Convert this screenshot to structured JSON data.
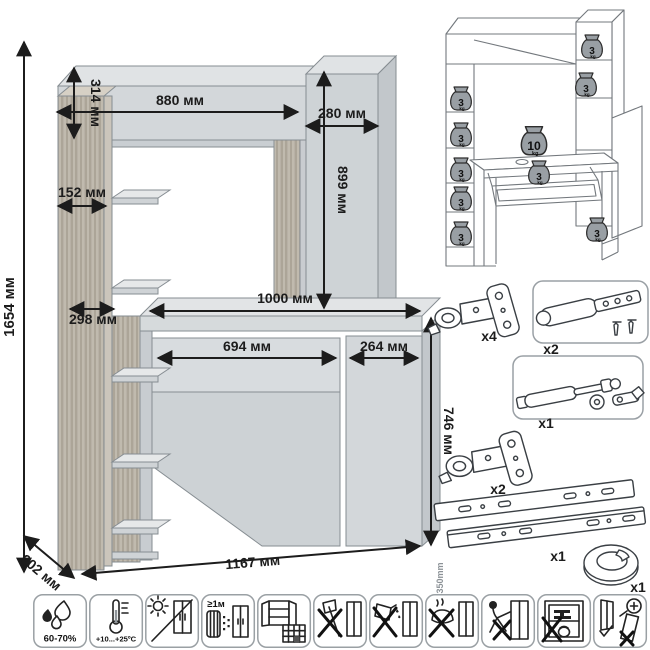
{
  "colors": {
    "panel": "#d3d7da",
    "panel_light": "#e0e3e5",
    "panel_side": "#c2c7cb",
    "wood": "#b8b1a6",
    "outline": "#868d92",
    "dimension": "#1c1c1c",
    "weight_fill": "#999fa4"
  },
  "dimensions": {
    "total_height": "1654 мм",
    "hutch_height": "314 мм",
    "hutch_width": "880 мм",
    "side_cabinet_width": "280 мм",
    "opening_height": "899 мм",
    "shelf_depth": "152 мм",
    "shelf_width": "298 мм",
    "desktop_width": "1000 мм",
    "drawer_width": "694 мм",
    "door_width": "264 мм",
    "desk_height": "746 мм",
    "depth": "602 мм",
    "total_width": "1167 мм"
  },
  "load_diagram": {
    "unit": "kg",
    "weights": [
      {
        "value": "3"
      },
      {
        "value": "3"
      },
      {
        "value": "3"
      },
      {
        "value": "3"
      },
      {
        "value": "3"
      },
      {
        "value": "3"
      },
      {
        "value": "3"
      },
      {
        "value": "10"
      },
      {
        "value": "3"
      },
      {
        "value": "3"
      }
    ]
  },
  "hardware": {
    "items": [
      {
        "name": "door-hinge",
        "count": "x4"
      },
      {
        "name": "door-damper",
        "count": "x2"
      },
      {
        "name": "gas-lift",
        "count": "x1"
      },
      {
        "name": "door-hinge",
        "count": "x2"
      },
      {
        "name": "drawer-slides",
        "count": "x1",
        "length": "350mm"
      },
      {
        "name": "cable-grommet",
        "count": "x1"
      }
    ]
  },
  "care_icons": {
    "humidity_label": "60-70%",
    "temperature_label": "+10...+25ºC",
    "distance_label": "≥1м",
    "names": [
      "humidity",
      "temperature",
      "no-direct-sunlight",
      "heat-source-distance",
      "level-floor",
      "no-impacts",
      "no-solvents",
      "no-hot-objects",
      "no-dragging",
      "no-overload",
      "anchor-tip-over"
    ]
  }
}
